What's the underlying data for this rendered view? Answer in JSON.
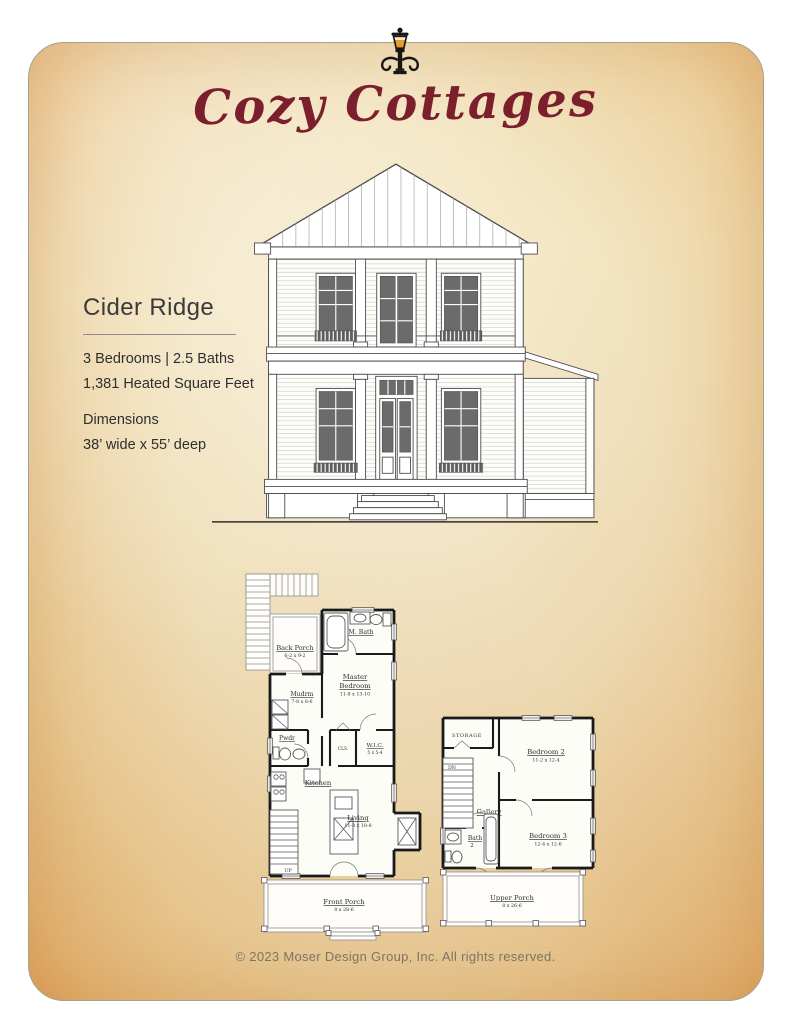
{
  "header": {
    "ornament_icon": "street-lamp",
    "brand_script": "Cozy Cottages"
  },
  "summary": {
    "plan_name": "Cider Ridge",
    "beds_baths": "3 Bedrooms | 2.5 Baths",
    "heated_area": "1,381 Heated Square Feet",
    "dimensions_label": "Dimensions",
    "dimensions_value": "38’ wide x 55’ deep"
  },
  "floor1": {
    "rooms": {
      "back_porch": {
        "name": "Back Porch",
        "dims": "6-2 x 9-2"
      },
      "m_bath": {
        "name": "M. Bath"
      },
      "master": {
        "line1": "Master",
        "line2": "Bedroom",
        "dims": "11-8 x 13-10"
      },
      "mudrm": {
        "name": "Mudrm",
        "dims": "7-8 x 8-6"
      },
      "pwdr": {
        "name": "Pwdr"
      },
      "cls": {
        "name": "CLS."
      },
      "wic": {
        "name": "W.I.C.",
        "dims": "5 x 5-4"
      },
      "kitchen": {
        "name": "Kitchen"
      },
      "living": {
        "name": "Living",
        "dims": "11-8 x 18-8"
      },
      "stairs": {
        "label": "UP"
      },
      "front_porch": {
        "name": "Front Porch",
        "dims": "8 x 28-6"
      }
    }
  },
  "floor2": {
    "rooms": {
      "storage": {
        "name": "STORAGE"
      },
      "bedroom2": {
        "name": "Bedroom 2",
        "dims": "11-2 x 12-4"
      },
      "stairs": {
        "label": "DN"
      },
      "gallery": {
        "name": "Gallery"
      },
      "bedroom3": {
        "name": "Bedroom 3",
        "dims": "12-4 x 12-6"
      },
      "bath2": {
        "line1": "Bath",
        "line2": "2"
      },
      "upper_porch": {
        "name": "Upper Porch",
        "dims": "8 x 26-6"
      }
    }
  },
  "footer": {
    "copyright": "© 2023 Moser Design Group, Inc. All rights reserved."
  },
  "colors": {
    "brand_red": "#7b1f2d",
    "parchment_center": "#f7f0da",
    "parchment_edge": "#e2a962",
    "ink": "#333333",
    "plan_wall": "#1a1a1a",
    "footer_text": "#7d7566"
  }
}
